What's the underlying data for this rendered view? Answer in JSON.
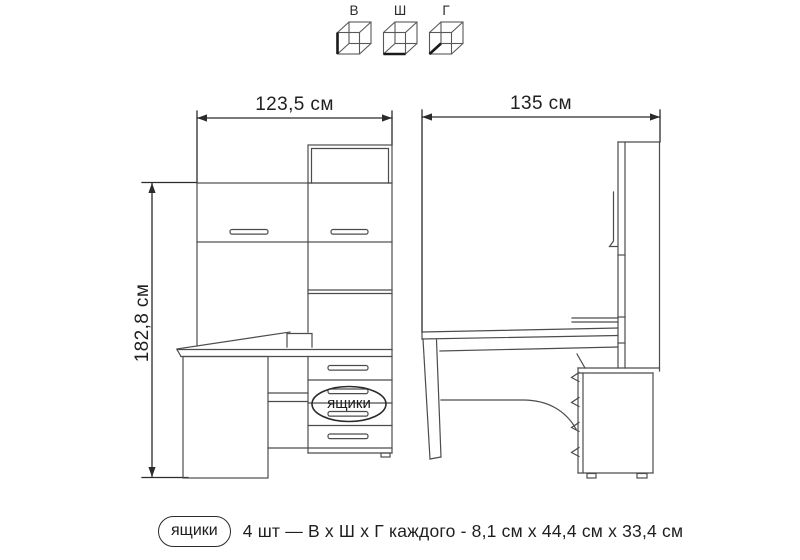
{
  "orientation_key": {
    "items": [
      {
        "label": "В",
        "meaning": "height",
        "icon": "cube-height-edge-icon"
      },
      {
        "label": "Ш",
        "meaning": "width",
        "icon": "cube-width-edge-icon"
      },
      {
        "label": "Г",
        "meaning": "depth",
        "icon": "cube-depth-edge-icon"
      }
    ]
  },
  "front_view": {
    "width_dimension": "123,5 см",
    "height_dimension": "182,8 см",
    "drawers_callout": "ящики"
  },
  "side_view": {
    "depth_dimension": "135 см"
  },
  "footer": {
    "badge_label": "ящики",
    "description": "4 шт — В х Ш х Г каждого - 8,1 см х 44,4 см х 33,4 см"
  },
  "colors": {
    "line": "#4c4c4c",
    "dimension": "#2b2b2b",
    "text": "#1f1f1f",
    "background": "#ffffff"
  }
}
